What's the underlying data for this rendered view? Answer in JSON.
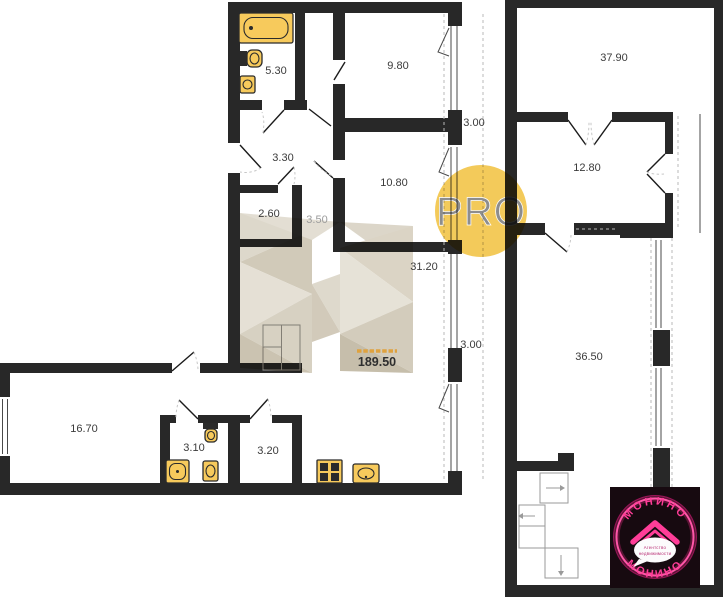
{
  "labels": {
    "bathroom_upper": "5.30",
    "bedroom_upper": "9.80",
    "hall_upper": "3.30",
    "room_upper_right": "10.80",
    "closet": "2.60",
    "hall_small": "3.50",
    "living_kitchen": "31.20",
    "balcony_upper": "3.00",
    "balcony_lower": "3.00",
    "total_area": "189.50",
    "room_top_right": "37.90",
    "room_mid_right": "12.80",
    "room_large_right": "36.50",
    "room_wing": "16.70",
    "bathroom_wing": "3.10",
    "storage_wing": "3.20"
  },
  "watermark": {
    "pro_label": "PRO"
  },
  "stamp": {
    "brand_top": "МОНИНО",
    "brand_bottom": "МОНИНО",
    "tagline_line1": "Агентство",
    "tagline_line2": "недвижимости"
  },
  "colors": {
    "wall": "#282828",
    "fixture_yellow": "#f7ca5c",
    "total_area_accent": "#dfa23e",
    "pro_circle": "#f2c64d",
    "stamp_pink": "#ff3d98",
    "stamp_background": "#170a10",
    "watermark_beige": "#d6cfc0"
  }
}
